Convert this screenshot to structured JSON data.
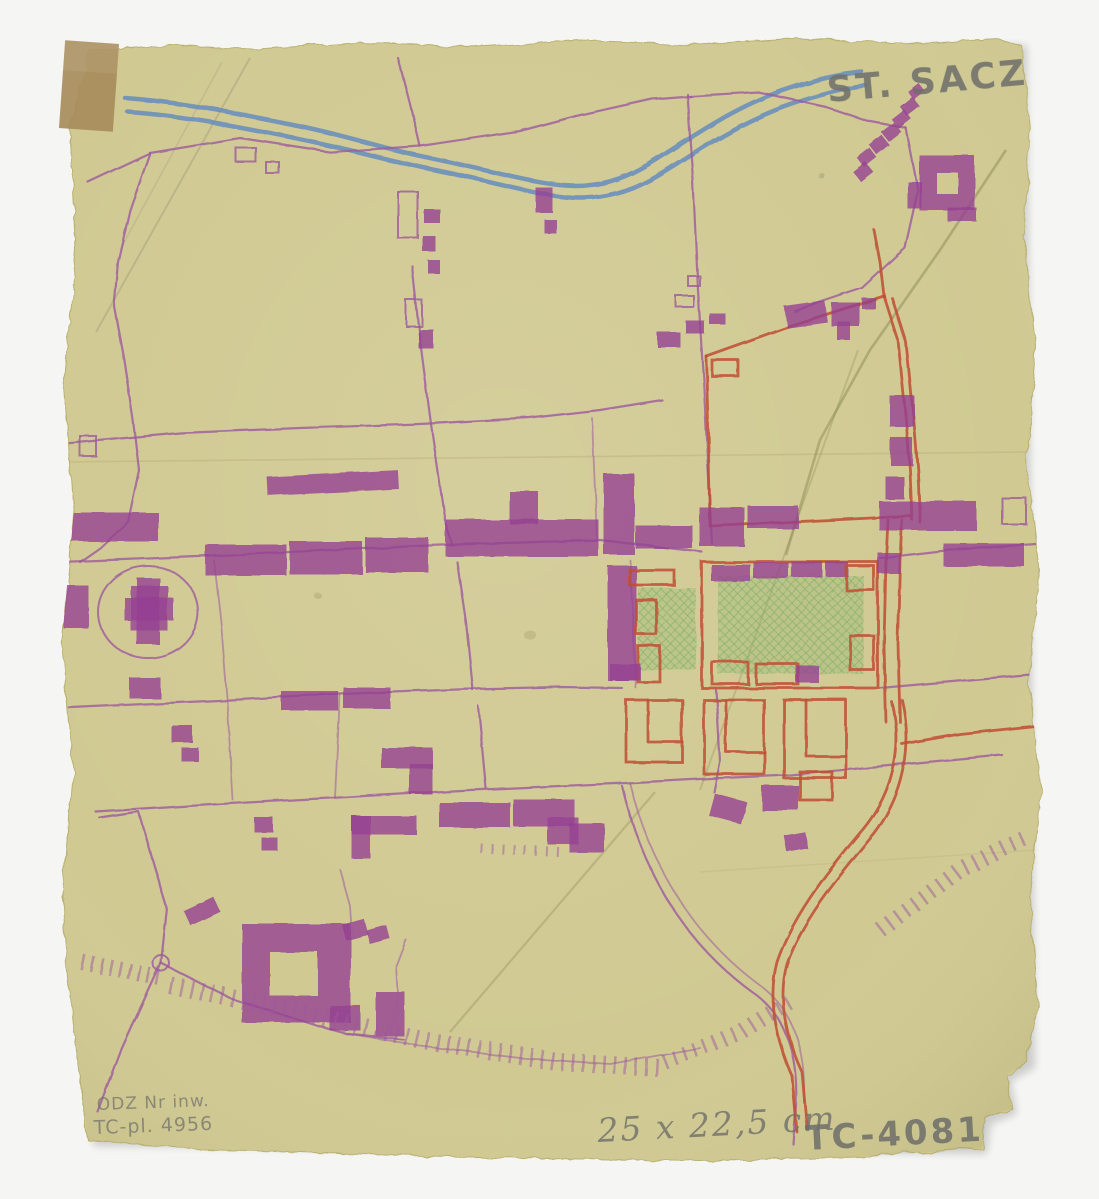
{
  "annotations": {
    "town_label": "ST. SACZ",
    "size_note": "25 x 22,5 cm",
    "catalog_code": "TC-4081",
    "inventory_line1": "ODZ Nr inw.",
    "inventory_line2": "TC-pl. 4956"
  },
  "features": {
    "river": "river (blue pencil)",
    "market_square": "green cross-hatched market square",
    "monastery": "monastery quadrangle with courtyard",
    "church": "church in oval churchyard",
    "escarpment": "hachured slope marks",
    "tape": "adhesive tape patch"
  },
  "palette": {
    "background": "#f5f5f3",
    "paper": "#d0c992",
    "paper_edge": "#b9b071",
    "tape": "#a78c5b",
    "river_blue": "#5f88c1",
    "road_purple": "#9c5a9e",
    "building_purple": "#953f93",
    "accent_red": "#c04e34",
    "square_green": "#7daf62",
    "pencil_gray": "#6e6e69",
    "crease_olive": "#8b8a55"
  }
}
